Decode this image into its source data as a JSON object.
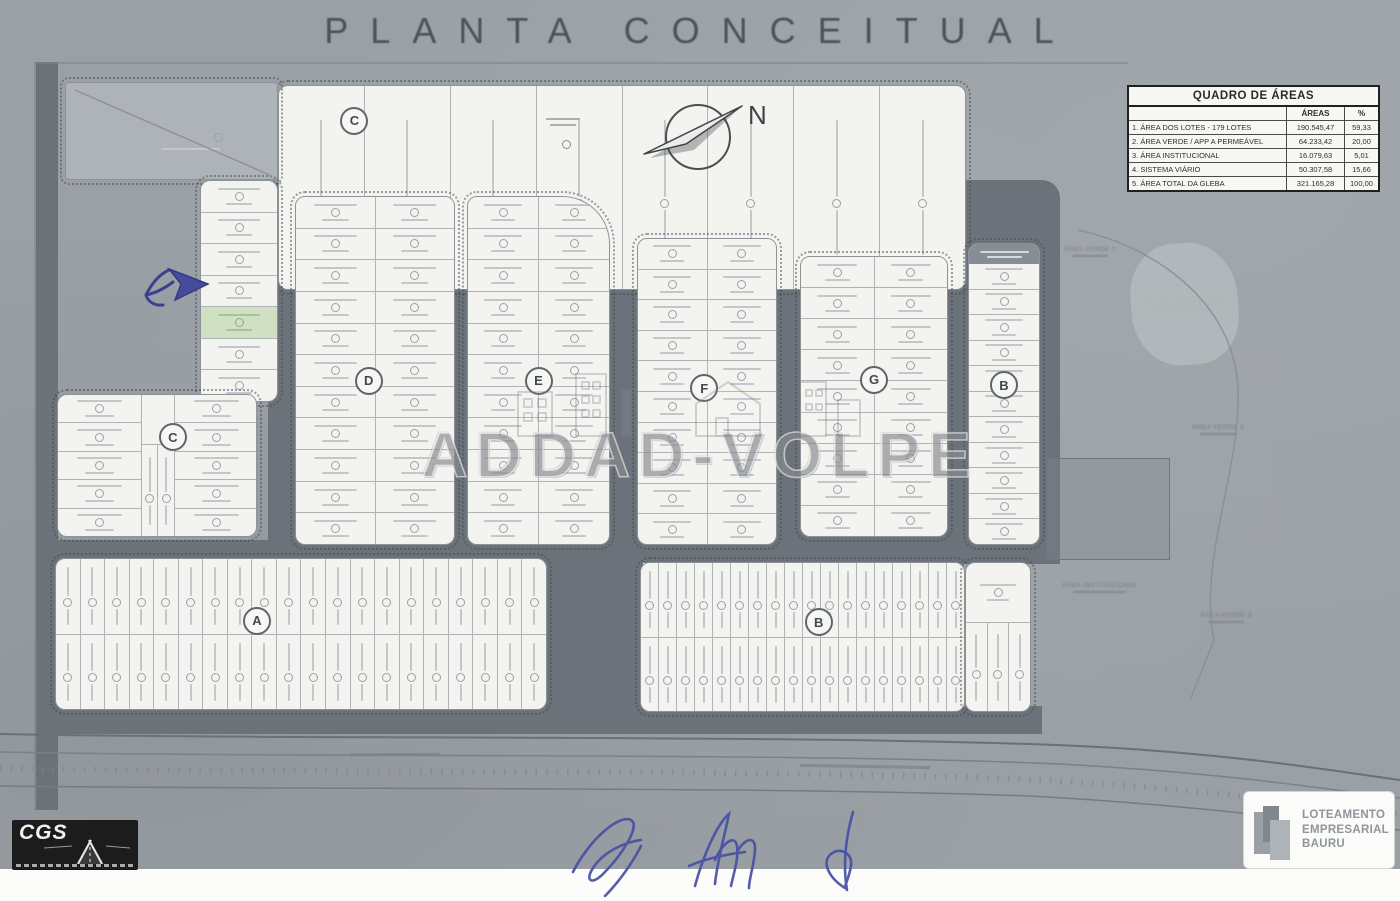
{
  "title": "PLANTA CONCEITUAL",
  "compass": {
    "label": "N"
  },
  "areas_table": {
    "title": "QUADRO DE ÁREAS",
    "col_headers": [
      "ÁREAS",
      "%"
    ],
    "rows": [
      {
        "name": "1. ÁREA DOS LOTES - 179 LOTES",
        "area": "190.545,47",
        "pct": "59,33"
      },
      {
        "name": "2. ÁREA VERDE / APP A PERMEÁVEL",
        "area": "64.233,42",
        "pct": "20,00"
      },
      {
        "name": "3. ÁREA INSTITUCIONAL",
        "area": "16.079,63",
        "pct": "5,01"
      },
      {
        "name": "4. SISTEMA VIÁRIO",
        "area": "50.307,58",
        "pct": "15,66"
      },
      {
        "name": "5. ÁREA TOTAL DA GLEBA",
        "area": "321.165,28",
        "pct": "100,00"
      }
    ]
  },
  "watermark": {
    "text": "ADDAD-VOLPE"
  },
  "brand_badge": {
    "lines": [
      "LOTEAMENTO",
      "EMPRESARIAL",
      "BAURU"
    ]
  },
  "cgs_logo": {
    "text": "CGS"
  },
  "plan": {
    "highlight_color": "#cfe0c3",
    "ink_color": "#4750a5",
    "blocks": [
      {
        "id": "quadra-C-top",
        "label": "C",
        "x": 278,
        "y": 85,
        "w": 688,
        "h": 205,
        "type": "cols",
        "n": 8,
        "label_pos": [
          11,
          17
        ]
      },
      {
        "id": "wedge-lot",
        "label": "",
        "x": 65,
        "y": 82,
        "w": 213,
        "h": 98,
        "type": "wedge"
      },
      {
        "id": "left-lot-column",
        "label": "",
        "x": 200,
        "y": 180,
        "w": 78,
        "h": 222,
        "type": "rows",
        "n": 7,
        "green": 4
      },
      {
        "id": "quadra-D",
        "label": "D",
        "x": 295,
        "y": 196,
        "w": 160,
        "h": 349,
        "type": "grid2",
        "n": 11,
        "label_pos": [
          46,
          53
        ]
      },
      {
        "id": "quadra-E",
        "label": "E",
        "x": 467,
        "y": 196,
        "w": 143,
        "h": 349,
        "type": "grid2",
        "n": 11,
        "label_pos": [
          50,
          53
        ],
        "cut": "tr"
      },
      {
        "id": "quadra-F",
        "label": "F",
        "x": 637,
        "y": 238,
        "w": 140,
        "h": 307,
        "type": "grid2",
        "n": 10,
        "label_pos": [
          48,
          49
        ]
      },
      {
        "id": "quadra-G",
        "label": "G",
        "x": 800,
        "y": 256,
        "w": 148,
        "h": 281,
        "type": "grid2",
        "n": 9,
        "label_pos": [
          50,
          44
        ]
      },
      {
        "id": "quadra-B-right",
        "label": "B",
        "x": 968,
        "y": 243,
        "w": 72,
        "h": 302,
        "type": "rows",
        "n": 11,
        "label_pos": [
          50,
          47
        ],
        "header": true
      },
      {
        "id": "quadra-C-left",
        "label": "C",
        "x": 57,
        "y": 394,
        "w": 200,
        "h": 143,
        "type": "leftC",
        "label_pos": [
          58,
          30
        ]
      },
      {
        "id": "quadra-A",
        "label": "A",
        "x": 55,
        "y": 558,
        "w": 492,
        "h": 152,
        "type": "rows2",
        "n": 20,
        "label_pos": [
          41,
          41
        ]
      },
      {
        "id": "quadra-B-bottom",
        "label": "B",
        "x": 640,
        "y": 562,
        "w": 325,
        "h": 150,
        "type": "rows2",
        "n": 18,
        "label_pos": [
          55,
          40
        ]
      },
      {
        "id": "quadra-B-ext",
        "label": "",
        "x": 965,
        "y": 562,
        "w": 66,
        "h": 150,
        "type": "ext"
      }
    ],
    "faint_labels": [
      {
        "text": "ÁREA VERDE 2",
        "x": 1090,
        "y": 246
      },
      {
        "text": "ÁREA DE CONSERVAÇÃO",
        "x": 1183,
        "y": 300
      },
      {
        "text": "ÁREA VERDE 1",
        "x": 1218,
        "y": 424
      },
      {
        "text": "ÁREA INSTITUCIONAL",
        "x": 1100,
        "y": 582
      },
      {
        "text": "ÁREA VERDE 3",
        "x": 1226,
        "y": 612
      }
    ]
  }
}
